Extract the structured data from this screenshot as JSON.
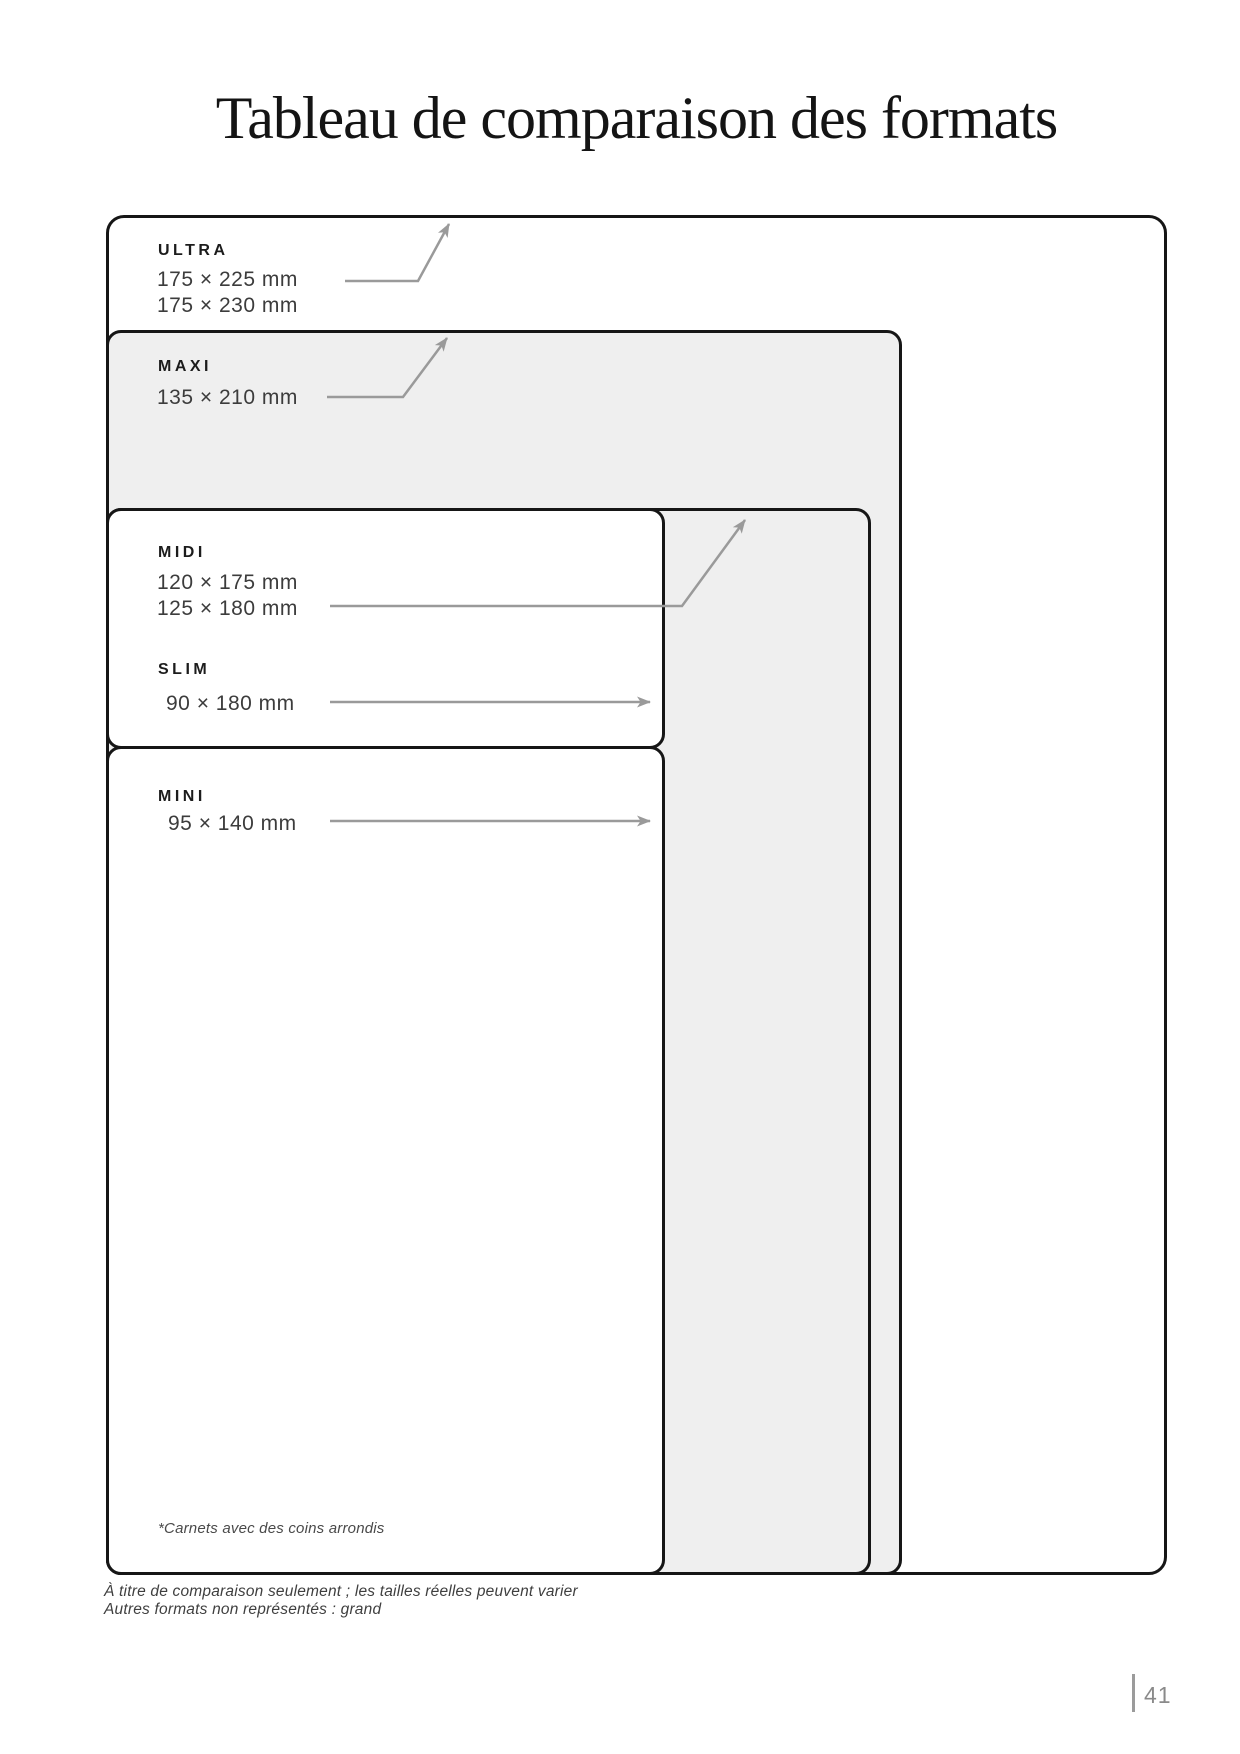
{
  "page": {
    "title": "Tableau de comparaison des formats",
    "page_number": "41"
  },
  "formats": [
    {
      "id": "ultra",
      "name": "ULTRA",
      "sizes": [
        "175 × 225 mm",
        "175 × 230 mm"
      ]
    },
    {
      "id": "maxi",
      "name": "MAXI",
      "sizes": [
        "135 × 210 mm"
      ]
    },
    {
      "id": "midi",
      "name": "MIDI",
      "sizes": [
        "120 × 175 mm",
        "125 × 180 mm"
      ]
    },
    {
      "id": "slim",
      "name": "SLIM",
      "sizes": [
        "90 × 180 mm"
      ]
    },
    {
      "id": "mini",
      "name": "MINI",
      "sizes": [
        "95 × 140 mm"
      ]
    }
  ],
  "notes": {
    "corner_note": "*Carnets avec des coins arrondis",
    "footer_line1": "À titre de comparaison seulement ; les tailles réelles peuvent varier",
    "footer_line2": "Autres formats non représentés : grand"
  },
  "colors": {
    "border": "#161616",
    "gray_fill": "#efefef",
    "arrow": "#9a9a9a",
    "name_text": "#1c1c1c",
    "size_text": "#3c3c3c",
    "note_text": "#3f3f3f",
    "page_number_text": "#8a8a8a"
  }
}
